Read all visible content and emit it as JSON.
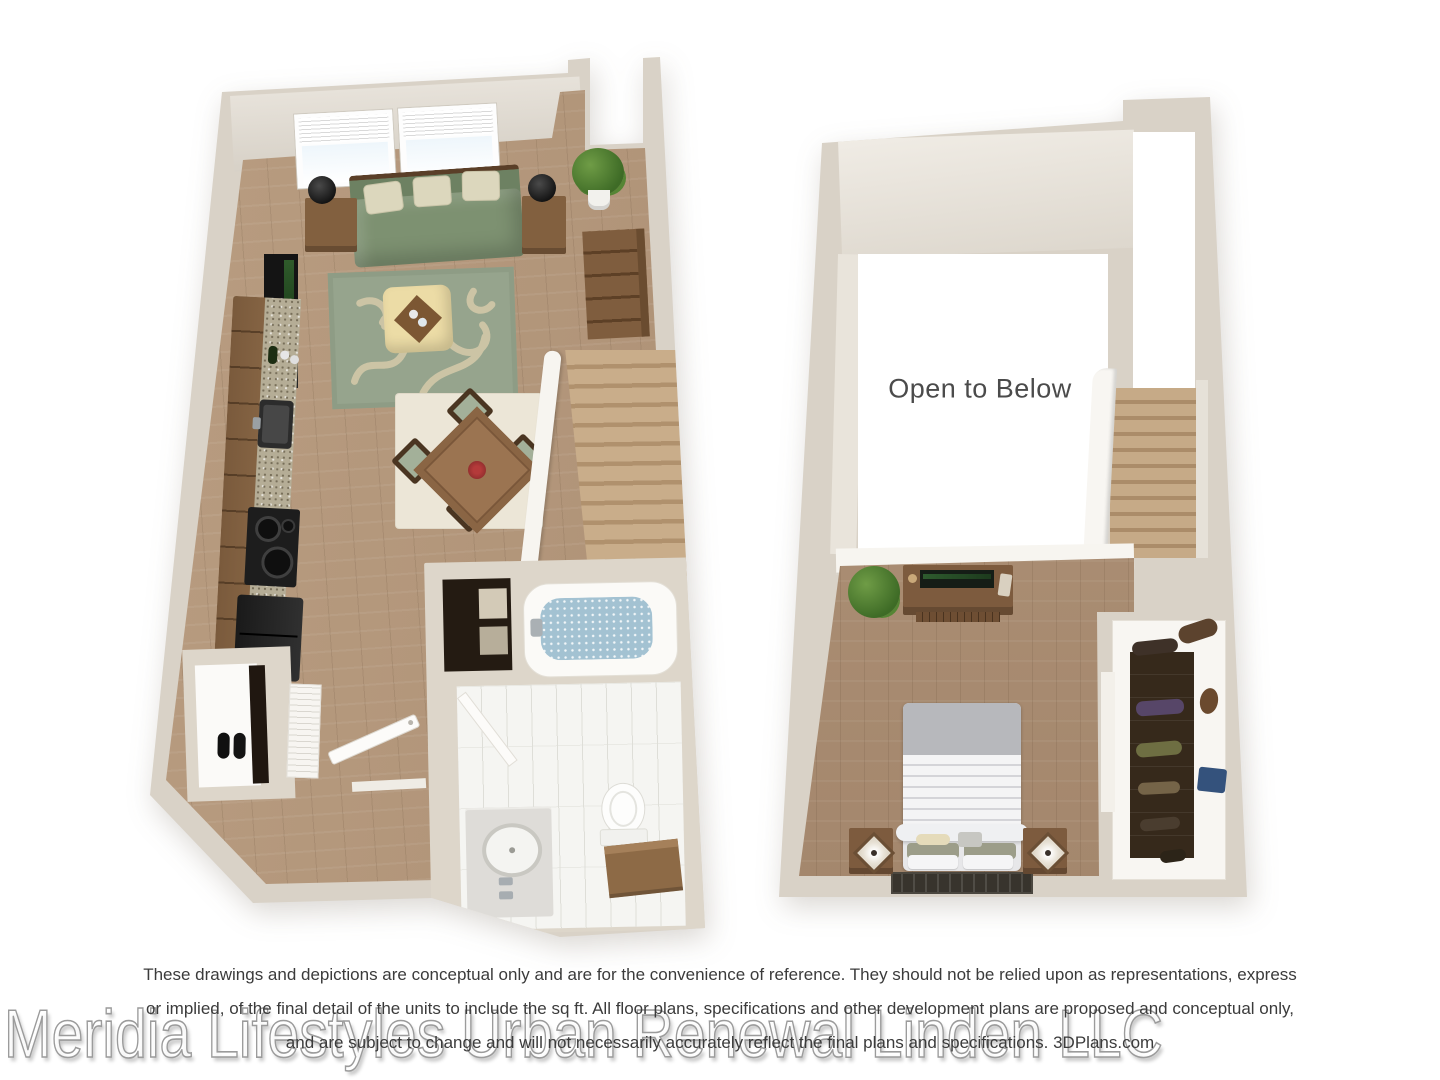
{
  "labels": {
    "open_to_below": "Open to Below"
  },
  "footer": {
    "disclaimer_lines": [
      "These drawings and depictions are conceptual only and are for the convenience of reference. They should not be relied upon as representations, express",
      "or implied, of the final detail of the units to include the sq ft. All floor plans, specifications and other development plans are proposed and conceptual only,",
      "and are subject to change and will not necessarily accurately reflect the final plans and specifications.  3DPlans.com"
    ],
    "watermark": "Meridia Lifestyles Urban Renewal Linden LLC"
  },
  "colors": {
    "background": "#ffffff",
    "wall": "#d9d2c7",
    "wood_floor": "#b1957a",
    "sofa_sage": "#7d9171",
    "rug_sage": "#96a48d",
    "ottoman_cream": "#ecdca6",
    "cabinet_brown": "#8f6d4a",
    "appliance_black": "#1d1d1d",
    "tub_water_blue": "#a3c2d2",
    "stair_wood": "#c9ad8a",
    "disclaimer_text": "#3b3b3b",
    "open_to_below_text": "#4b4b4b",
    "watermark_stroke": "#9b9b9b"
  }
}
